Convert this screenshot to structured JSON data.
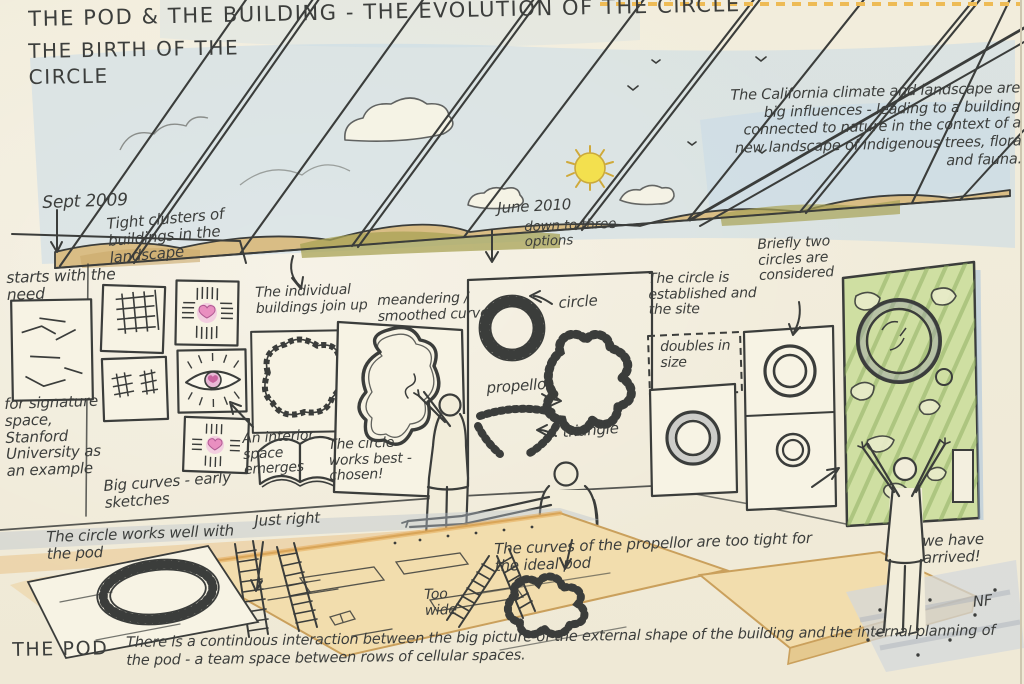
{
  "titles": {
    "main": "THE POD & THE BUILDING - THE EVOLUTION OF THE CIRCLE",
    "sub": "THE BIRTH OF THE CIRCLE"
  },
  "timeline": {
    "start": "Sept 2009",
    "milestone": "June 2010",
    "milestone_note": "down to three options"
  },
  "shapes": {
    "circle": "circle",
    "propellor": "propellor",
    "triangle": "triangle"
  },
  "annotations": {
    "california": "The California climate and landscape are big influences - leading to a building connected to nature in the context of a new landscape of indigenous trees, flora and fauna.",
    "starts_with_need": "starts with the need",
    "tight_clusters": "Tight clusters of buildings in the landscape",
    "signature_space": "for signature space, Stanford University as an example",
    "big_curves": "Big curves - early sketches",
    "interior_space": "An interior space emerges",
    "buildings_join": "The individual buildings join up",
    "meandering": "meandering / smoothed curves",
    "circle_works_best": "The circle works best - chosen!",
    "circle_established": "The circle is established and the site",
    "doubles_in_size": "doubles in size",
    "two_circles": "Briefly two circles are considered",
    "circle_works_pod": "The circle works well with the pod",
    "just_right": "Just right",
    "too_wide": "Too wide",
    "propellor_too_tight": "The curves of the propellor are too tight for the ideal pod",
    "we_have_arrived": "we have arrived!",
    "the_pod": "THE POD",
    "pod_caption": "There is a continuous interaction between the big picture of the external shape of the building and the internal planning of the pod - a team space between rows of cellular spaces."
  },
  "artist": {
    "signature": "NF"
  },
  "colors": {
    "ink": "#3b3d3b",
    "paper": "#f1ecdb",
    "sky_blue": "#b9d4ea",
    "sun_yellow": "#f3e04e",
    "hill_tan": "#d9bd85",
    "hill_olive": "#a8a355",
    "plan_green": "#cfdfa2",
    "heart_pink": "#e98fc0",
    "table_tan": "#f2ddad",
    "stitch_orange": "#eebb55"
  }
}
